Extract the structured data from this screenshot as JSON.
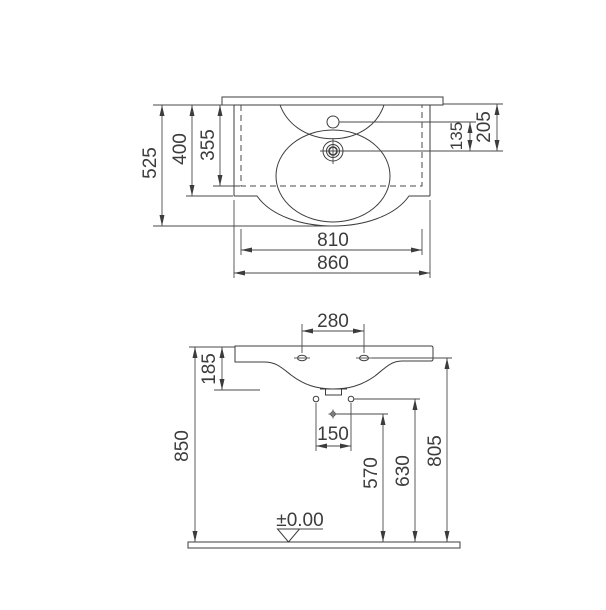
{
  "drawing_type": "washbasin-technical-dimension-drawing",
  "colors": {
    "line": "#3c3c3c",
    "text": "#3c3c3c",
    "hatch_line": "#8f8f8f",
    "hatch_bg": "#cccccc",
    "background": "#ffffff"
  },
  "top_view": {
    "dim_depth_total": "525",
    "dim_depth_body": "400",
    "dim_depth_inner": "355",
    "dim_tap_to_drain": "135",
    "dim_wall_to_drain": "205",
    "dim_width_inner": "810",
    "dim_width_total": "860"
  },
  "front_view": {
    "dim_taphole_spacing": "280",
    "dim_basin_front_height": "185",
    "dim_total_height": "850",
    "dim_lower_hole_spacing": "150",
    "dim_mid_hole_height": "570",
    "dim_side_hole_height": "630",
    "dim_fixing_hole_height": "805",
    "floor_level_label": "±0.00"
  }
}
